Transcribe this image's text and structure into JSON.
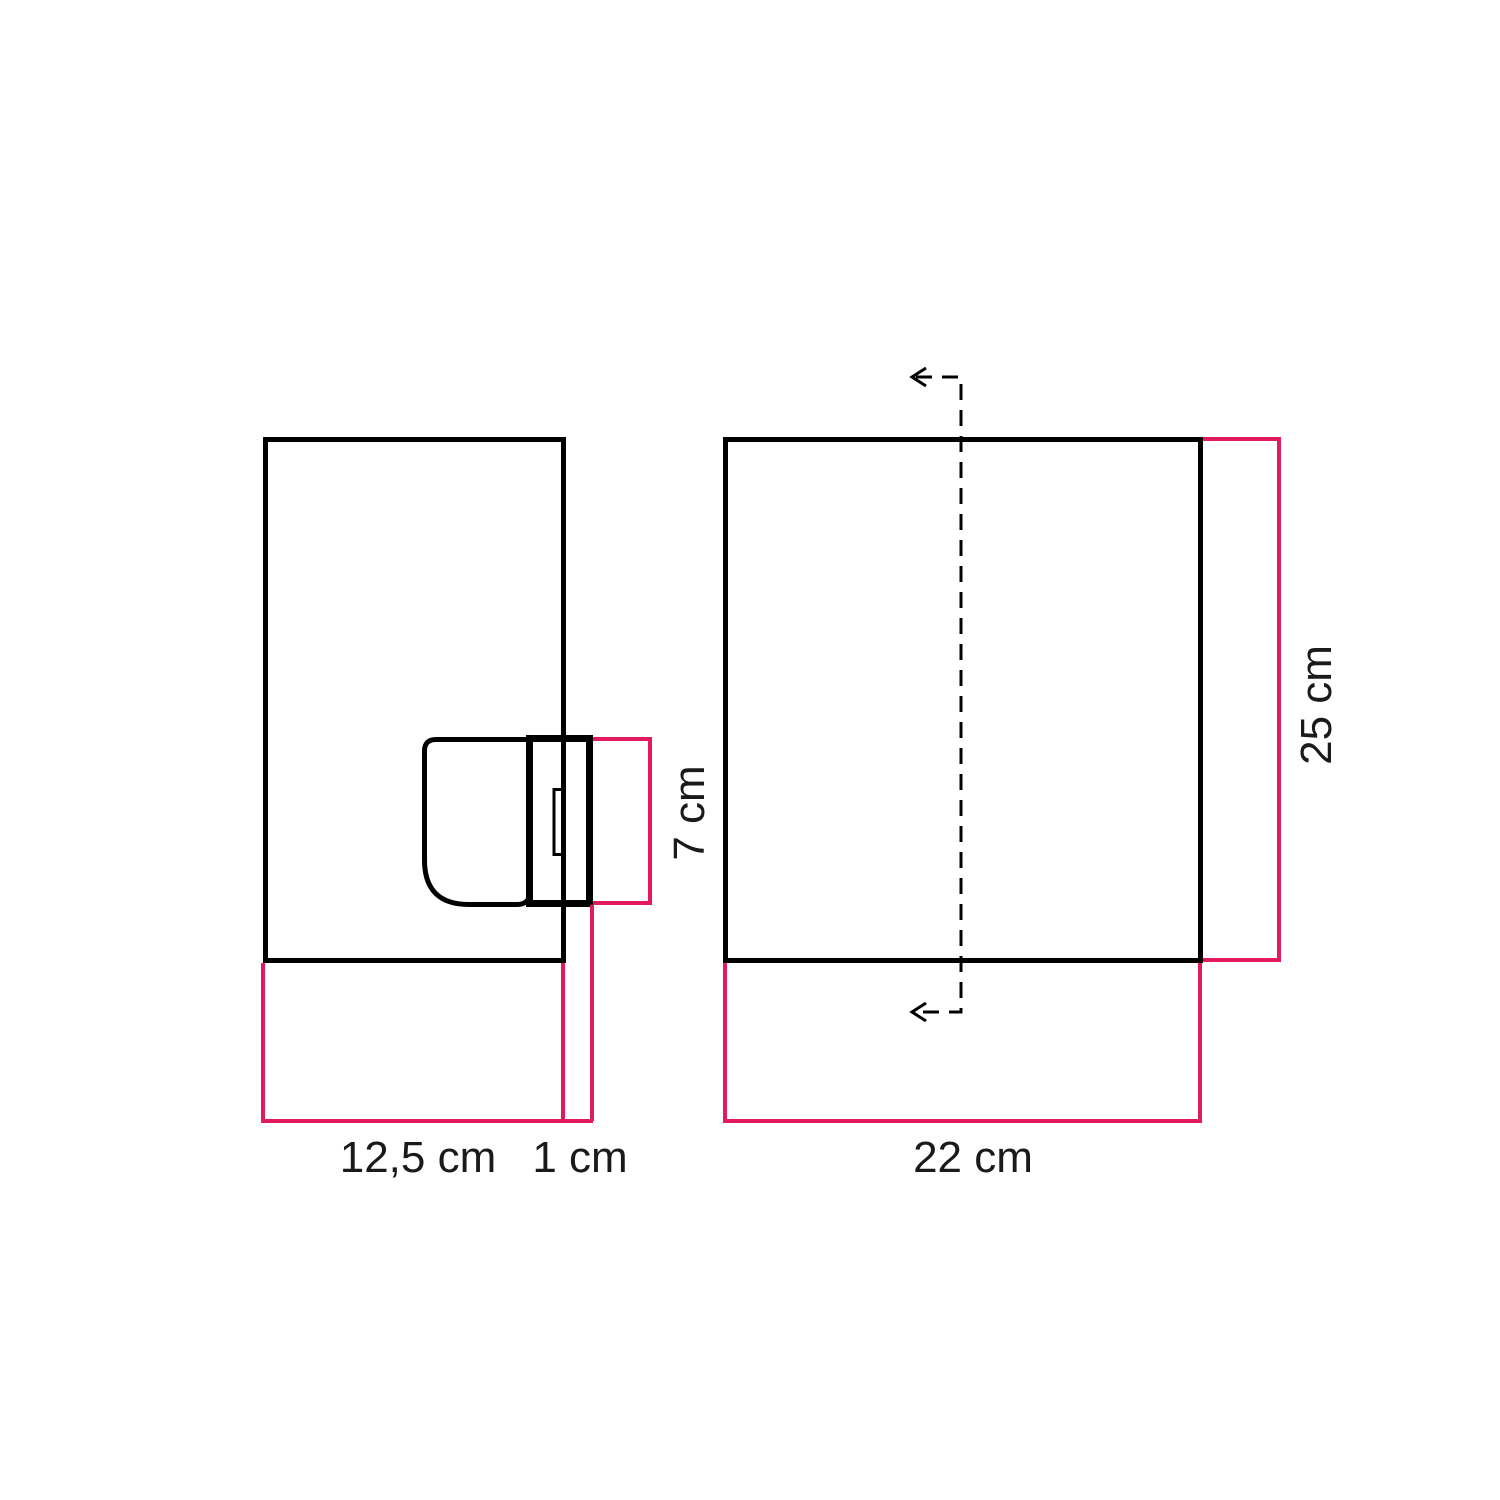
{
  "diagram_type": "technical-dimension-drawing",
  "colors": {
    "outline": "#000000",
    "dimension_line": "#e31a5d",
    "background": "#ffffff",
    "label_text": "#1a1a1a"
  },
  "front_view": {
    "plate_width_label": "12,5 cm",
    "holder_protrusion_label": "1 cm",
    "holder_height_label": "7 cm"
  },
  "side_view": {
    "width_label": "22 cm",
    "height_label": "25 cm"
  }
}
